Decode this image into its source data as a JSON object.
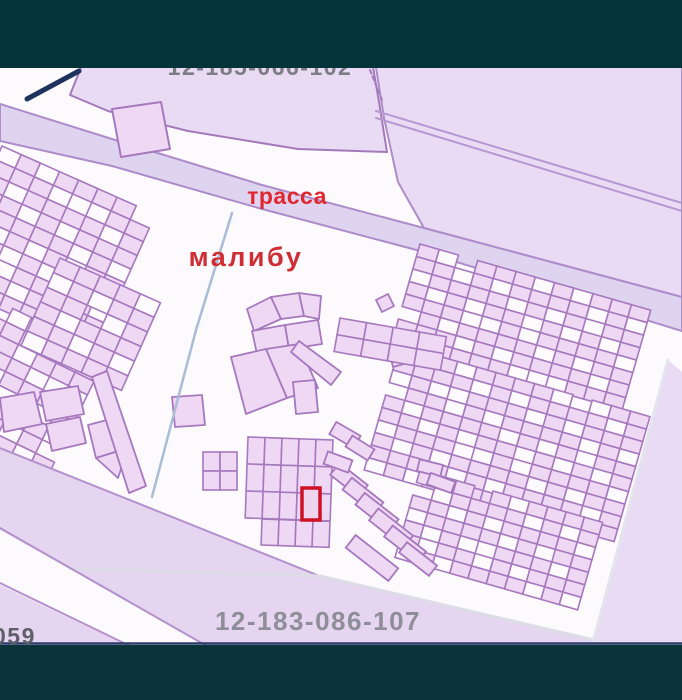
{
  "frame": {
    "top_bar_color": "#04333a",
    "bottom_bar_color": "#0b343a"
  },
  "map": {
    "labels": {
      "road": {
        "text": "трасса",
        "color": "#e0262e"
      },
      "area": {
        "text": "малибу",
        "color": "#cf2d34"
      },
      "parcel_top": {
        "text": "12-185-066-102",
        "color": "#7d7d85"
      },
      "parcel_bottom": {
        "text": "12-183-086-107",
        "color": "#8e8e98"
      },
      "corner": {
        "text": "059",
        "color": "#5d6167"
      }
    },
    "highlight": {
      "stroke": "#d01025",
      "fill": "#eed5ee"
    },
    "colors": {
      "white": "#fdfafd",
      "region": "#e9dbf4",
      "road": "#ded4ef",
      "bottom": "#e6d5f1",
      "parcel": "#efd8f4",
      "parcelStroke": "#a678bd",
      "regionStroke": "#ad8cc9",
      "blueBoundary": "#a9bdd8",
      "grayBoundary": "#dcdde6",
      "whiteBoundary": "#e3e4ee",
      "navyLine": "#2b3c68",
      "navyMark": "#20335e",
      "doubleLine": "#b697d2",
      "bandStroke": "#b291cc"
    }
  }
}
